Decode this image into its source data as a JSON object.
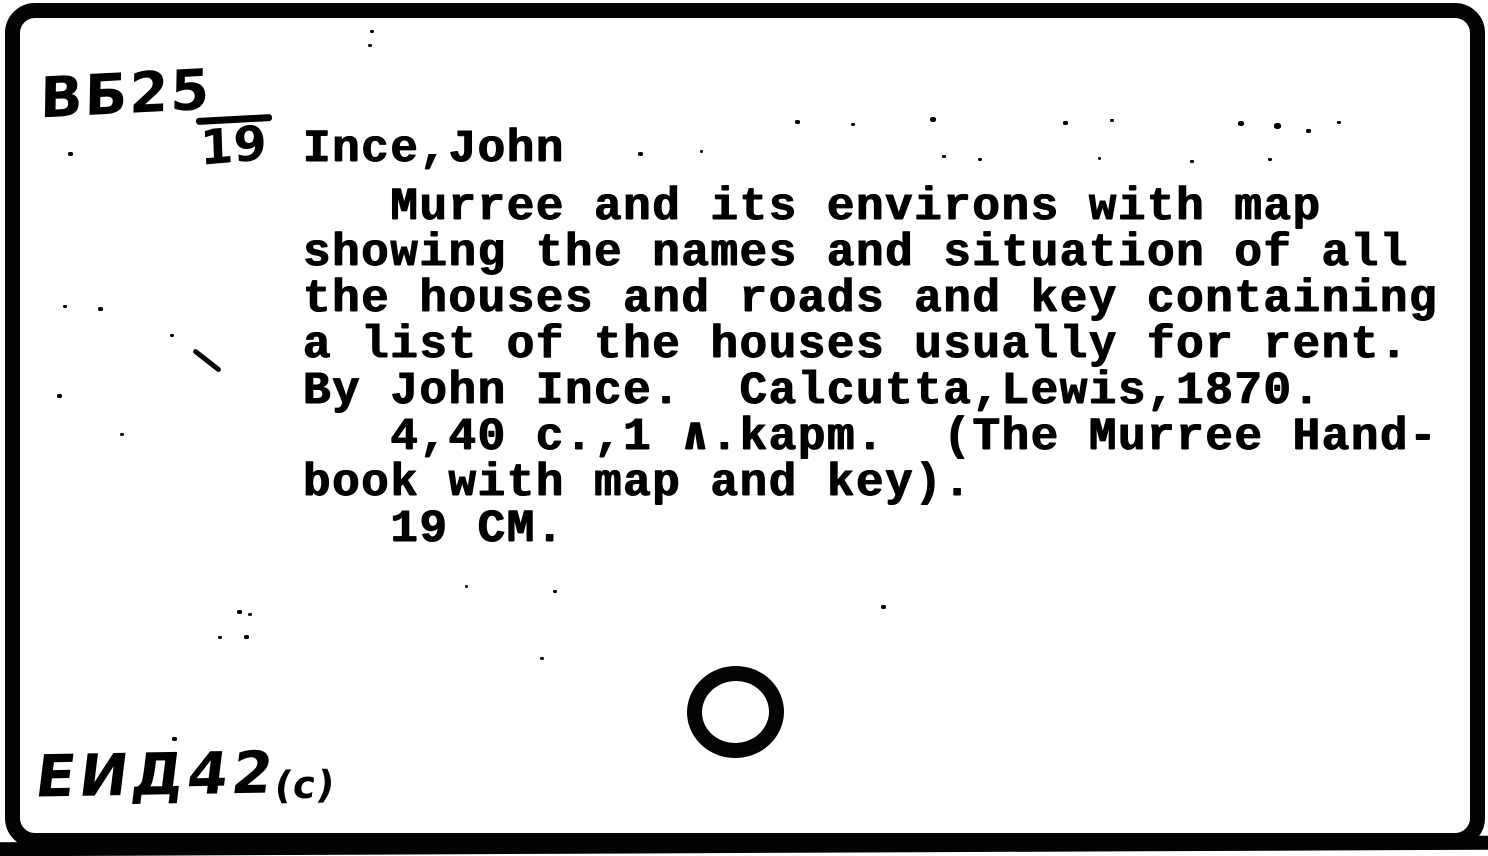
{
  "card": {
    "call_number": {
      "top": "ВБ25",
      "bottom": "19"
    },
    "heading": "Ince,John",
    "typed_lines": [
      "   Murree and its environs with map",
      "showing the names and situation of all",
      "the houses and roads and key containing",
      "a list of the houses usually for rent.",
      "By John Ince.  Calcutta,Lewis,1870.",
      "   4,40 c.,1 ∧.kapm.  (The Murree Hand-",
      "book with map and key).",
      "   19 CM."
    ],
    "shelf_mark": {
      "main": "ЕИД42",
      "suffix": "(с)"
    }
  },
  "colors": {
    "ink": "#000000",
    "paper": "#ffffff"
  }
}
